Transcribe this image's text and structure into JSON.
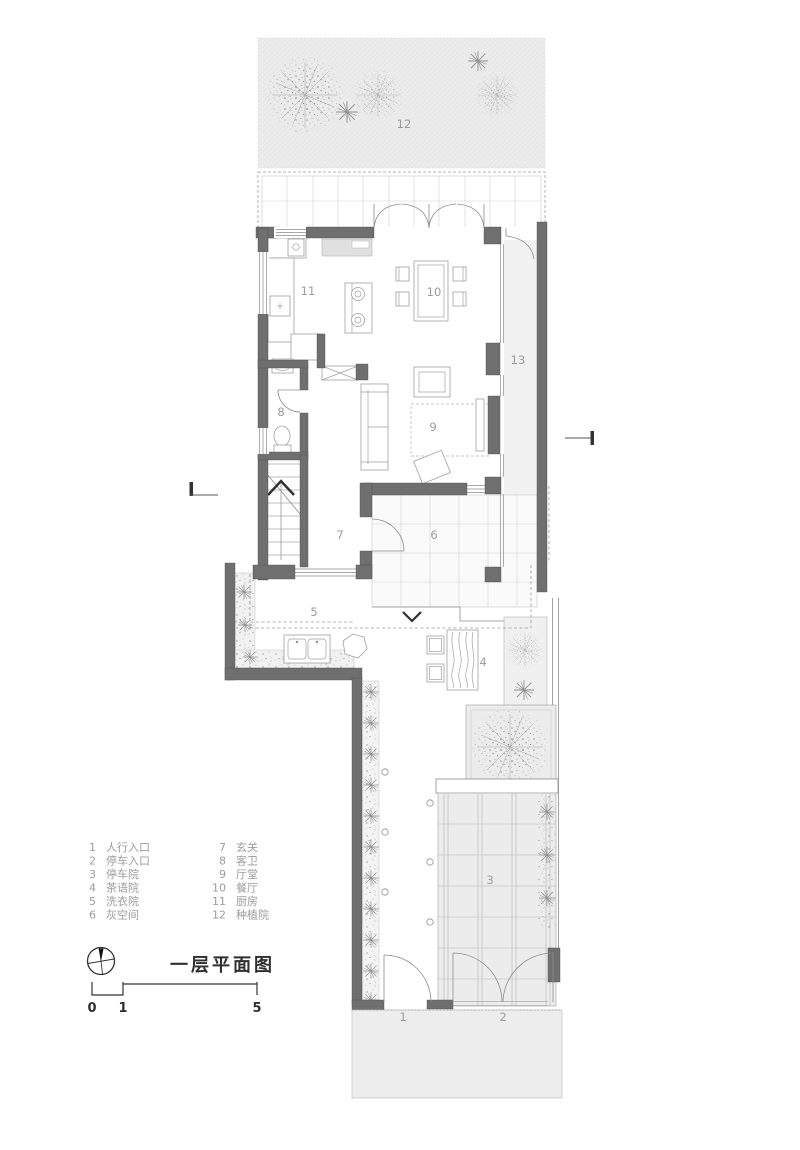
{
  "drawing": {
    "title": "一层平面图",
    "scale_bar": {
      "start": "0",
      "mid": "1",
      "end": "5"
    }
  },
  "legend": {
    "items": [
      {
        "num": "1",
        "label": "人行入口"
      },
      {
        "num": "2",
        "label": "停车入口"
      },
      {
        "num": "3",
        "label": "停车院"
      },
      {
        "num": "4",
        "label": "茶语院"
      },
      {
        "num": "5",
        "label": "洗衣院"
      },
      {
        "num": "6",
        "label": "灰空间"
      },
      {
        "num": "7",
        "label": "玄关"
      },
      {
        "num": "8",
        "label": "客卫"
      },
      {
        "num": "9",
        "label": "厅堂"
      },
      {
        "num": "10",
        "label": "餐厅"
      },
      {
        "num": "11",
        "label": "厨房"
      },
      {
        "num": "12",
        "label": "种植院"
      }
    ]
  },
  "plan_labels": {
    "p1": "1",
    "p2": "2",
    "p3": "3",
    "p4": "4",
    "p5": "5",
    "p6": "6",
    "p7": "7",
    "p8": "8",
    "p9": "9",
    "p10": "10",
    "p11": "11",
    "p12": "12",
    "p13": "13"
  },
  "colors": {
    "wall": "#6f6f6f",
    "hatch_background": "#ececec",
    "label_text": "#9c9c9c",
    "title_text": "#2f2f2f"
  }
}
